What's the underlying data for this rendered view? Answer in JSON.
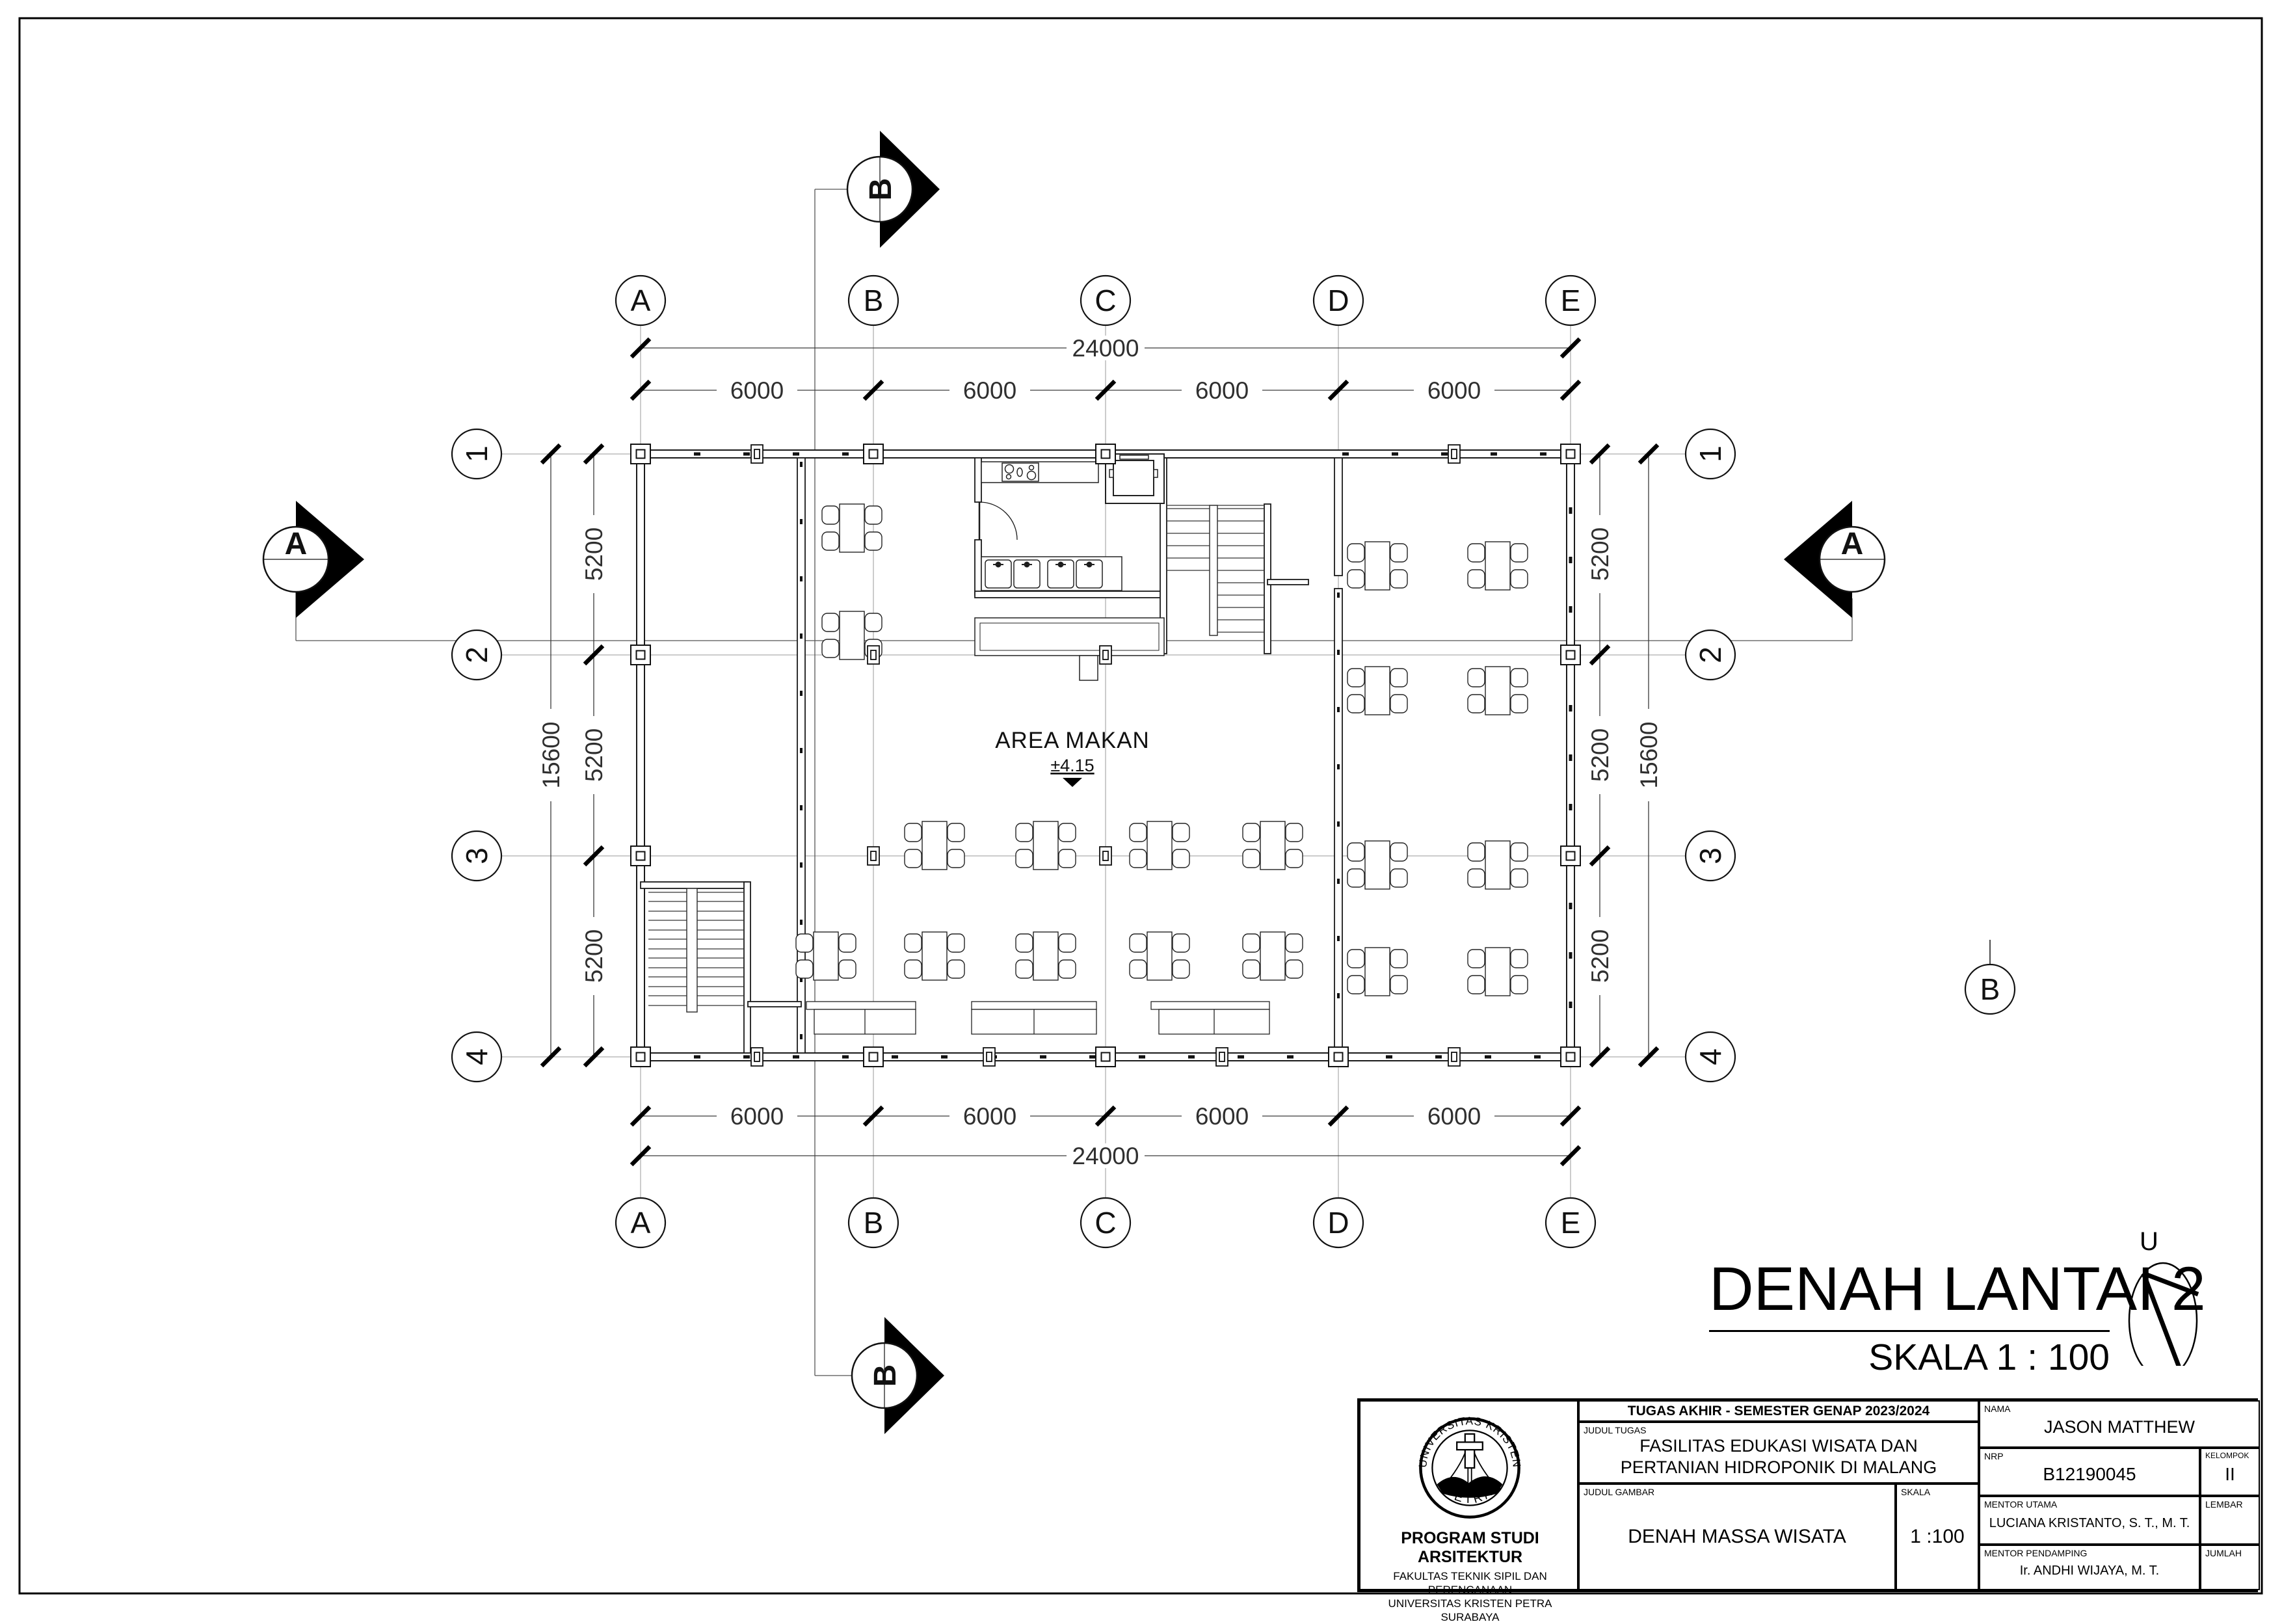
{
  "sheet": {
    "title": "DENAH LANTAI 2",
    "scale_label": "SKALA 1 : 100",
    "north_label": "U"
  },
  "grid": {
    "cols": [
      "A",
      "B",
      "C",
      "D",
      "E"
    ],
    "rows": [
      "1",
      "2",
      "3",
      "4"
    ],
    "stray_bubble": "B"
  },
  "dimensions": {
    "top_total": "24000",
    "top_segments": [
      "6000",
      "6000",
      "6000",
      "6000"
    ],
    "bottom_total": "24000",
    "bottom_segments": [
      "6000",
      "6000",
      "6000",
      "6000"
    ],
    "left_total": "15600",
    "left_segments": [
      "5200",
      "5200",
      "5200"
    ],
    "right_total": "15600",
    "right_segments": [
      "5200",
      "5200",
      "5200"
    ]
  },
  "section_markers": {
    "a": "A",
    "b": "B"
  },
  "rooms": {
    "dining": {
      "name": "AREA MAKAN",
      "elevation": "±4.15"
    }
  },
  "title_block": {
    "header": "TUGAS AKHIR - SEMESTER GENAP 2023/2024",
    "judul_tugas_label": "JUDUL TUGAS",
    "judul_tugas_line1": "FASILITAS EDUKASI WISATA DAN",
    "judul_tugas_line2": "PERTANIAN HIDROPONIK DI MALANG",
    "judul_gambar_label": "JUDUL GAMBAR",
    "judul_gambar": "DENAH MASSA WISATA",
    "skala_label": "SKALA",
    "skala": "1 :100",
    "nama_label": "NAMA",
    "nama": "JASON MATTHEW",
    "nrp_label": "NRP",
    "nrp": "B12190045",
    "kelompok_label": "KELOMPOK",
    "kelompok": "II",
    "mentor_utama_label": "MENTOR UTAMA",
    "mentor_utama": "LUCIANA KRISTANTO, S. T., M. T.",
    "mentor_pendamping_label": "MENTOR PENDAMPING",
    "mentor_pendamping": "Ir. ANDHI WIJAYA, M. T.",
    "lembar_label": "LEMBAR",
    "jumlah_label": "JUMLAH",
    "institution": {
      "logo_top": "UNIVERSITAS KRISTEN",
      "logo_bottom": "PETRA",
      "program": "PROGRAM STUDI ARSITEKTUR",
      "fakultas": "FAKULTAS TEKNIK SIPIL DAN PERENCANAAN",
      "universitas": "UNIVERSITAS KRISTEN PETRA",
      "kota": "SURABAYA"
    }
  }
}
